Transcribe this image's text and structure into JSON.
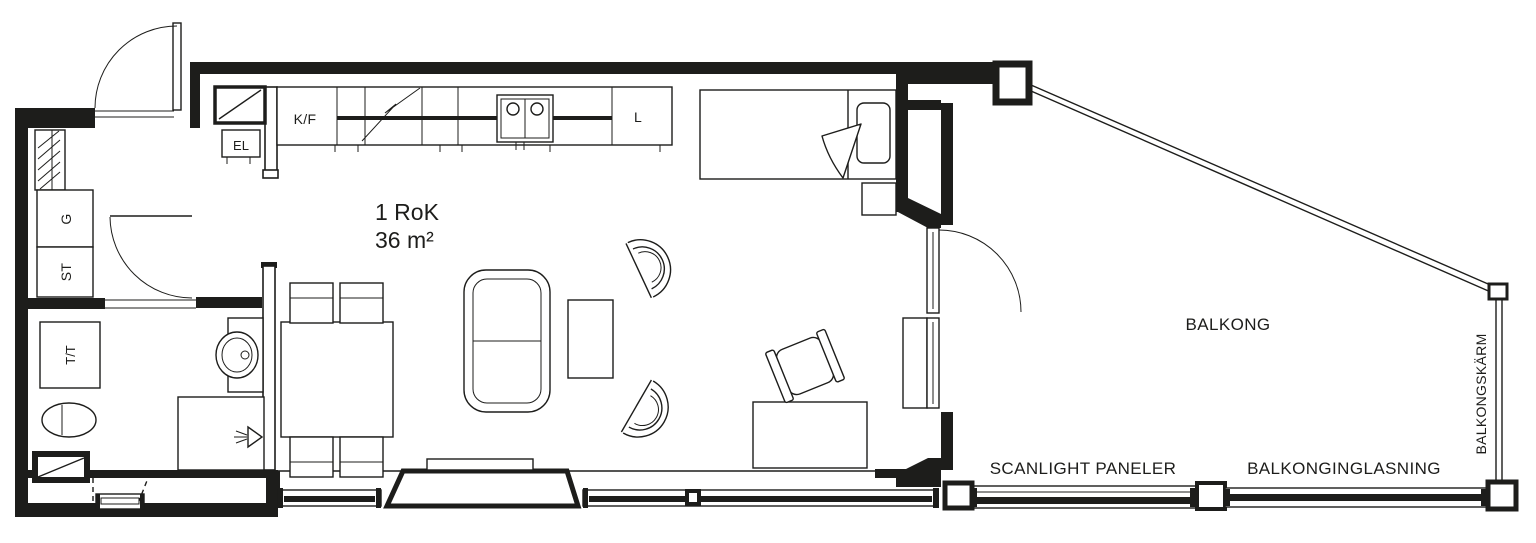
{
  "plan": {
    "title": "1 RoK",
    "area": "36 m²",
    "kitchen": {
      "fridge_freezer": "K/F",
      "electrical_cabinet": "EL",
      "larder": "L"
    },
    "hall": {
      "wardrobe": "G",
      "cleaning_cabinet": "ST"
    },
    "bathroom": {
      "washer_dryer": "T/T"
    },
    "balcony": {
      "name": "BALKONG",
      "scanlight_panels": "SCANLIGHT PANELER",
      "glazing": "BALKONGINGLASNING",
      "screen": "BALKONGSKÄRM"
    }
  },
  "colors": {
    "line": "#1d1d1b",
    "background": "#ffffff"
  }
}
